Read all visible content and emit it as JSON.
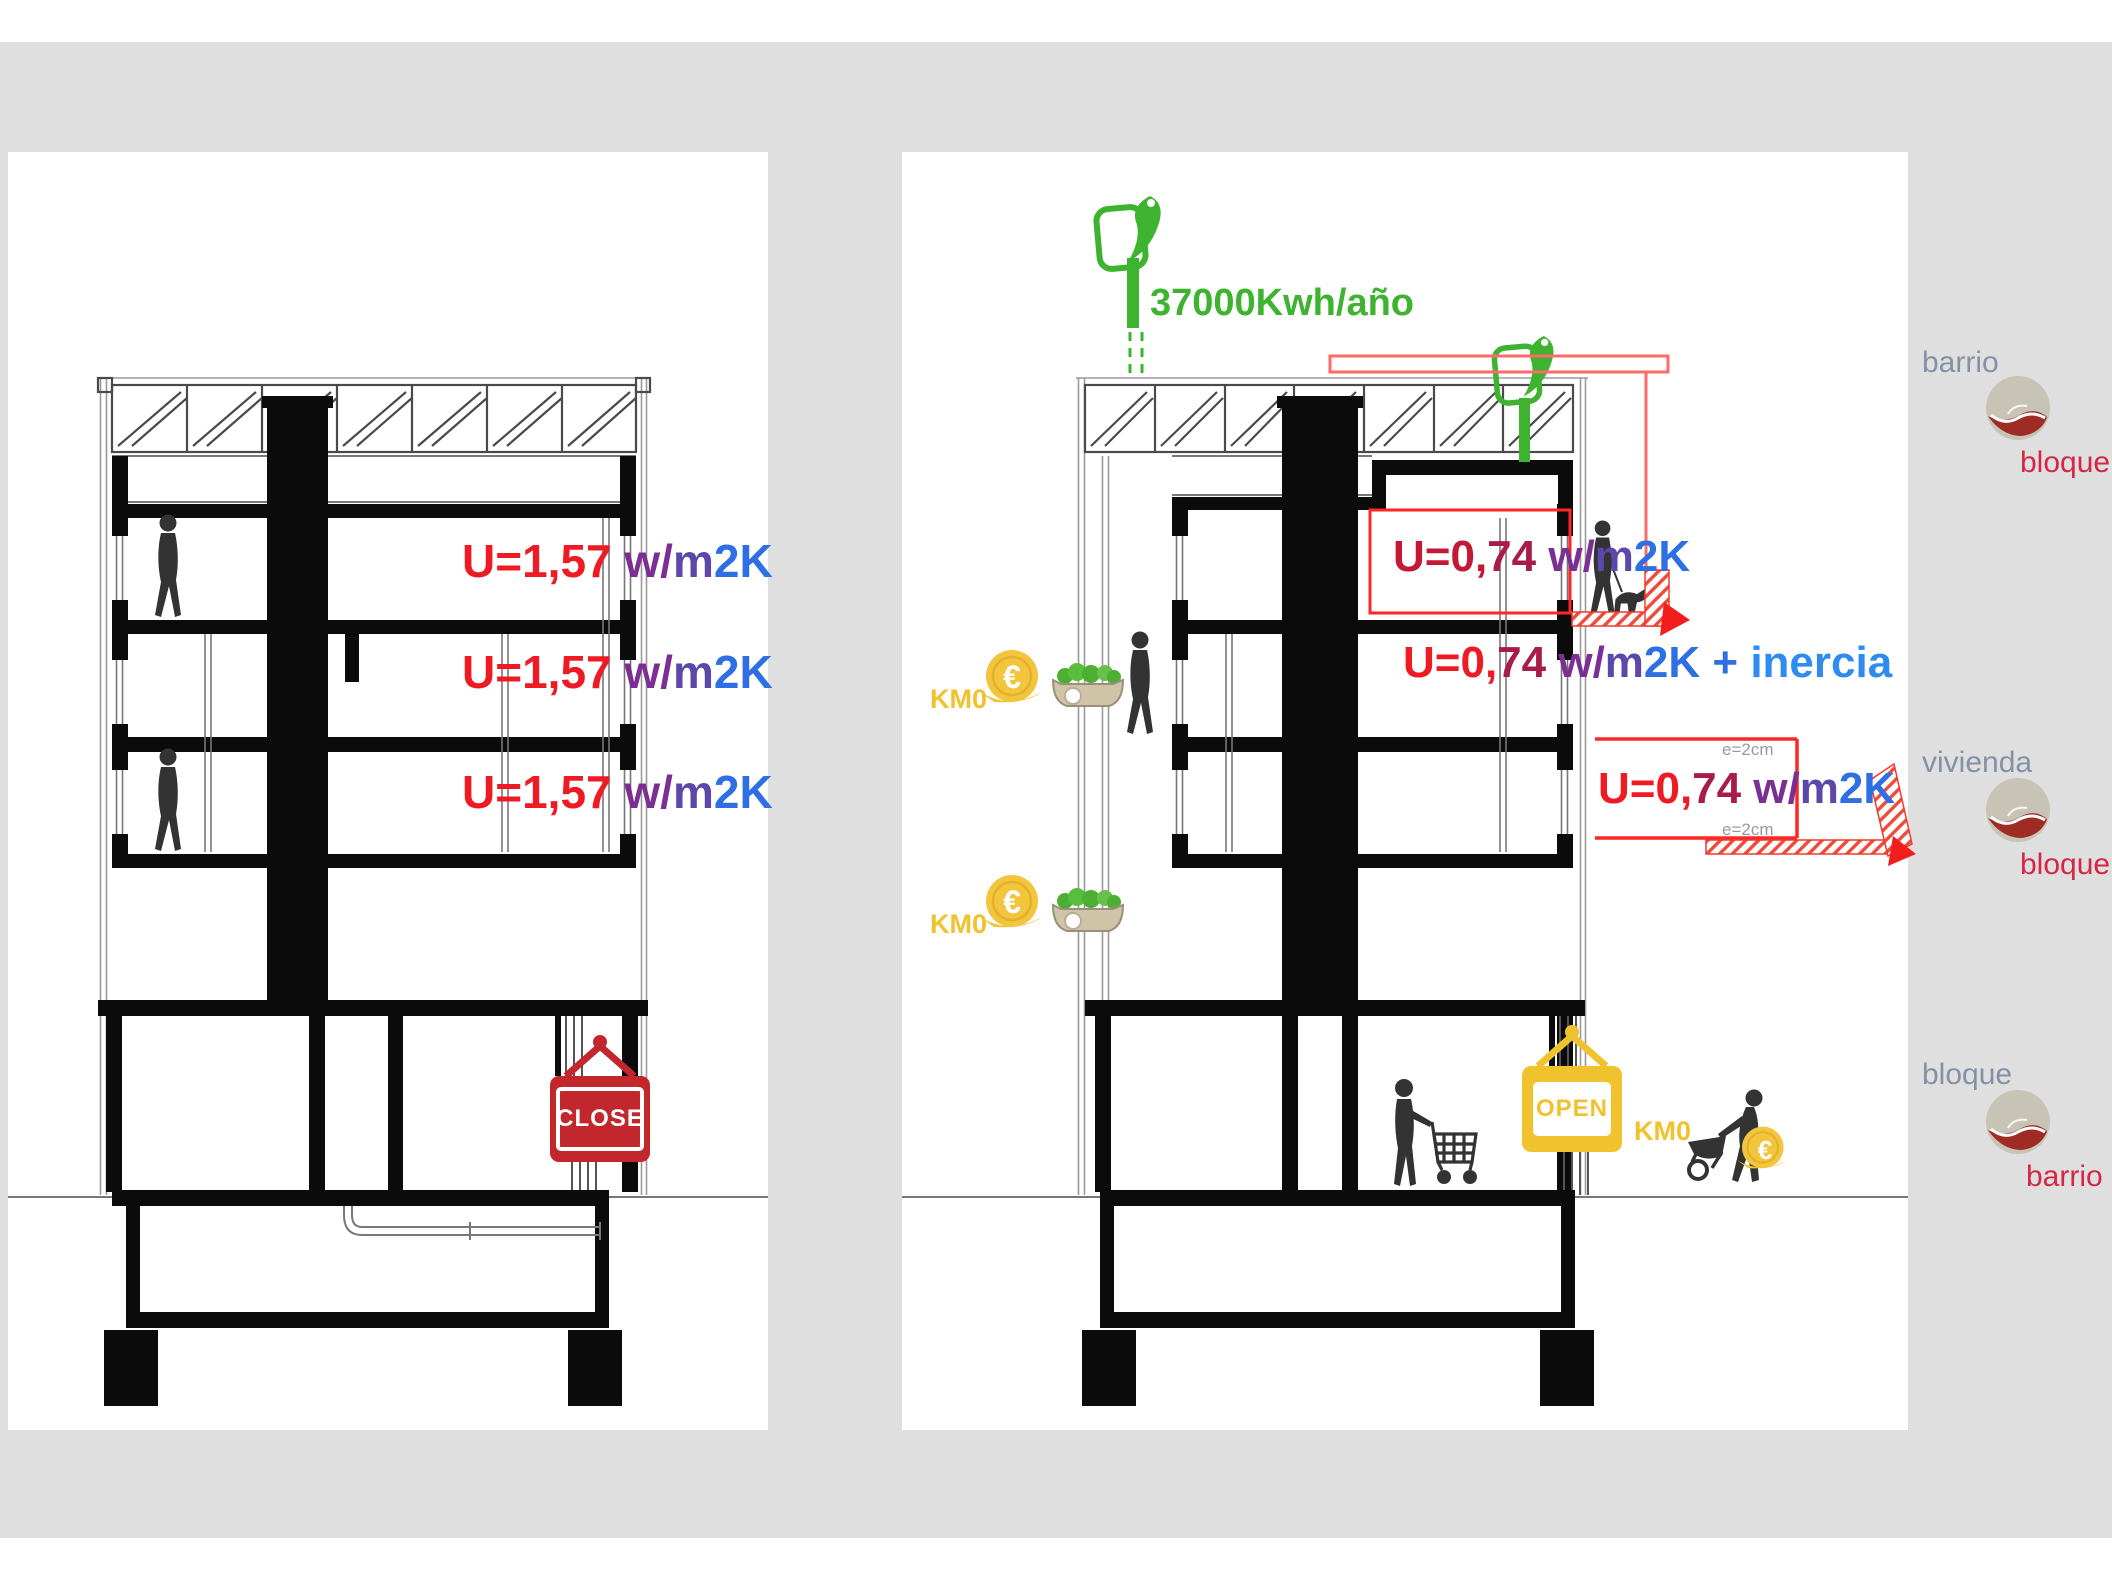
{
  "background": {
    "band_color": "#dfdfdf",
    "panel_color": "#ffffff"
  },
  "left_panel": {
    "u_rows": [
      {
        "u": "U=1,57 ",
        "w": "w/",
        "m": "m",
        "k": "2K"
      },
      {
        "u": "U=1,57 ",
        "w": "w/",
        "m": "m",
        "k": "2K"
      },
      {
        "u": "U=1,57 ",
        "w": "w/",
        "m": "m",
        "k": "2K"
      }
    ],
    "close_sign": "CLOSE"
  },
  "right_panel": {
    "energy_label": "37000Kwh/año",
    "u_row1": {
      "u1": "U=0,",
      "u2": "74 ",
      "w": "w/",
      "m": "m",
      "k": "2K"
    },
    "u_row2": {
      "u1": "U=0,",
      "u2": "74 ",
      "w": "w/",
      "m": "m",
      "k": "2K",
      "plus": " + ",
      "inercia": "inercia"
    },
    "u_row3": {
      "u1": "U=0,",
      "u2": "74 ",
      "w": "w/",
      "m": "m",
      "k": "2K"
    },
    "e_top": "e=2cm",
    "e_bottom": "e=2cm",
    "km0_1": "KM0",
    "km0_2": "KM0",
    "km0_3": "KM0",
    "open_sign": "OPEN",
    "euro": "€"
  },
  "legend": [
    {
      "top": "barrio",
      "bottom": "bloque"
    },
    {
      "top": "vivienda",
      "bottom": "bloque"
    },
    {
      "top": "bloque",
      "bottom": "barrio"
    }
  ],
  "colors": {
    "red_bright": "#ef1b24",
    "red_dark": "#a81d48",
    "purple": "#7b2f92",
    "violet": "#5b48a8",
    "blue": "#2f6fe4",
    "blue_light": "#2e8cf0",
    "green": "#3db32f",
    "yellow": "#f0c32e",
    "close_red": "#c1272d",
    "legend_gray": "#8292a6",
    "legend_red": "#d62646",
    "logo_tan": "#c8c4b5",
    "logo_red": "#9e2b24"
  }
}
